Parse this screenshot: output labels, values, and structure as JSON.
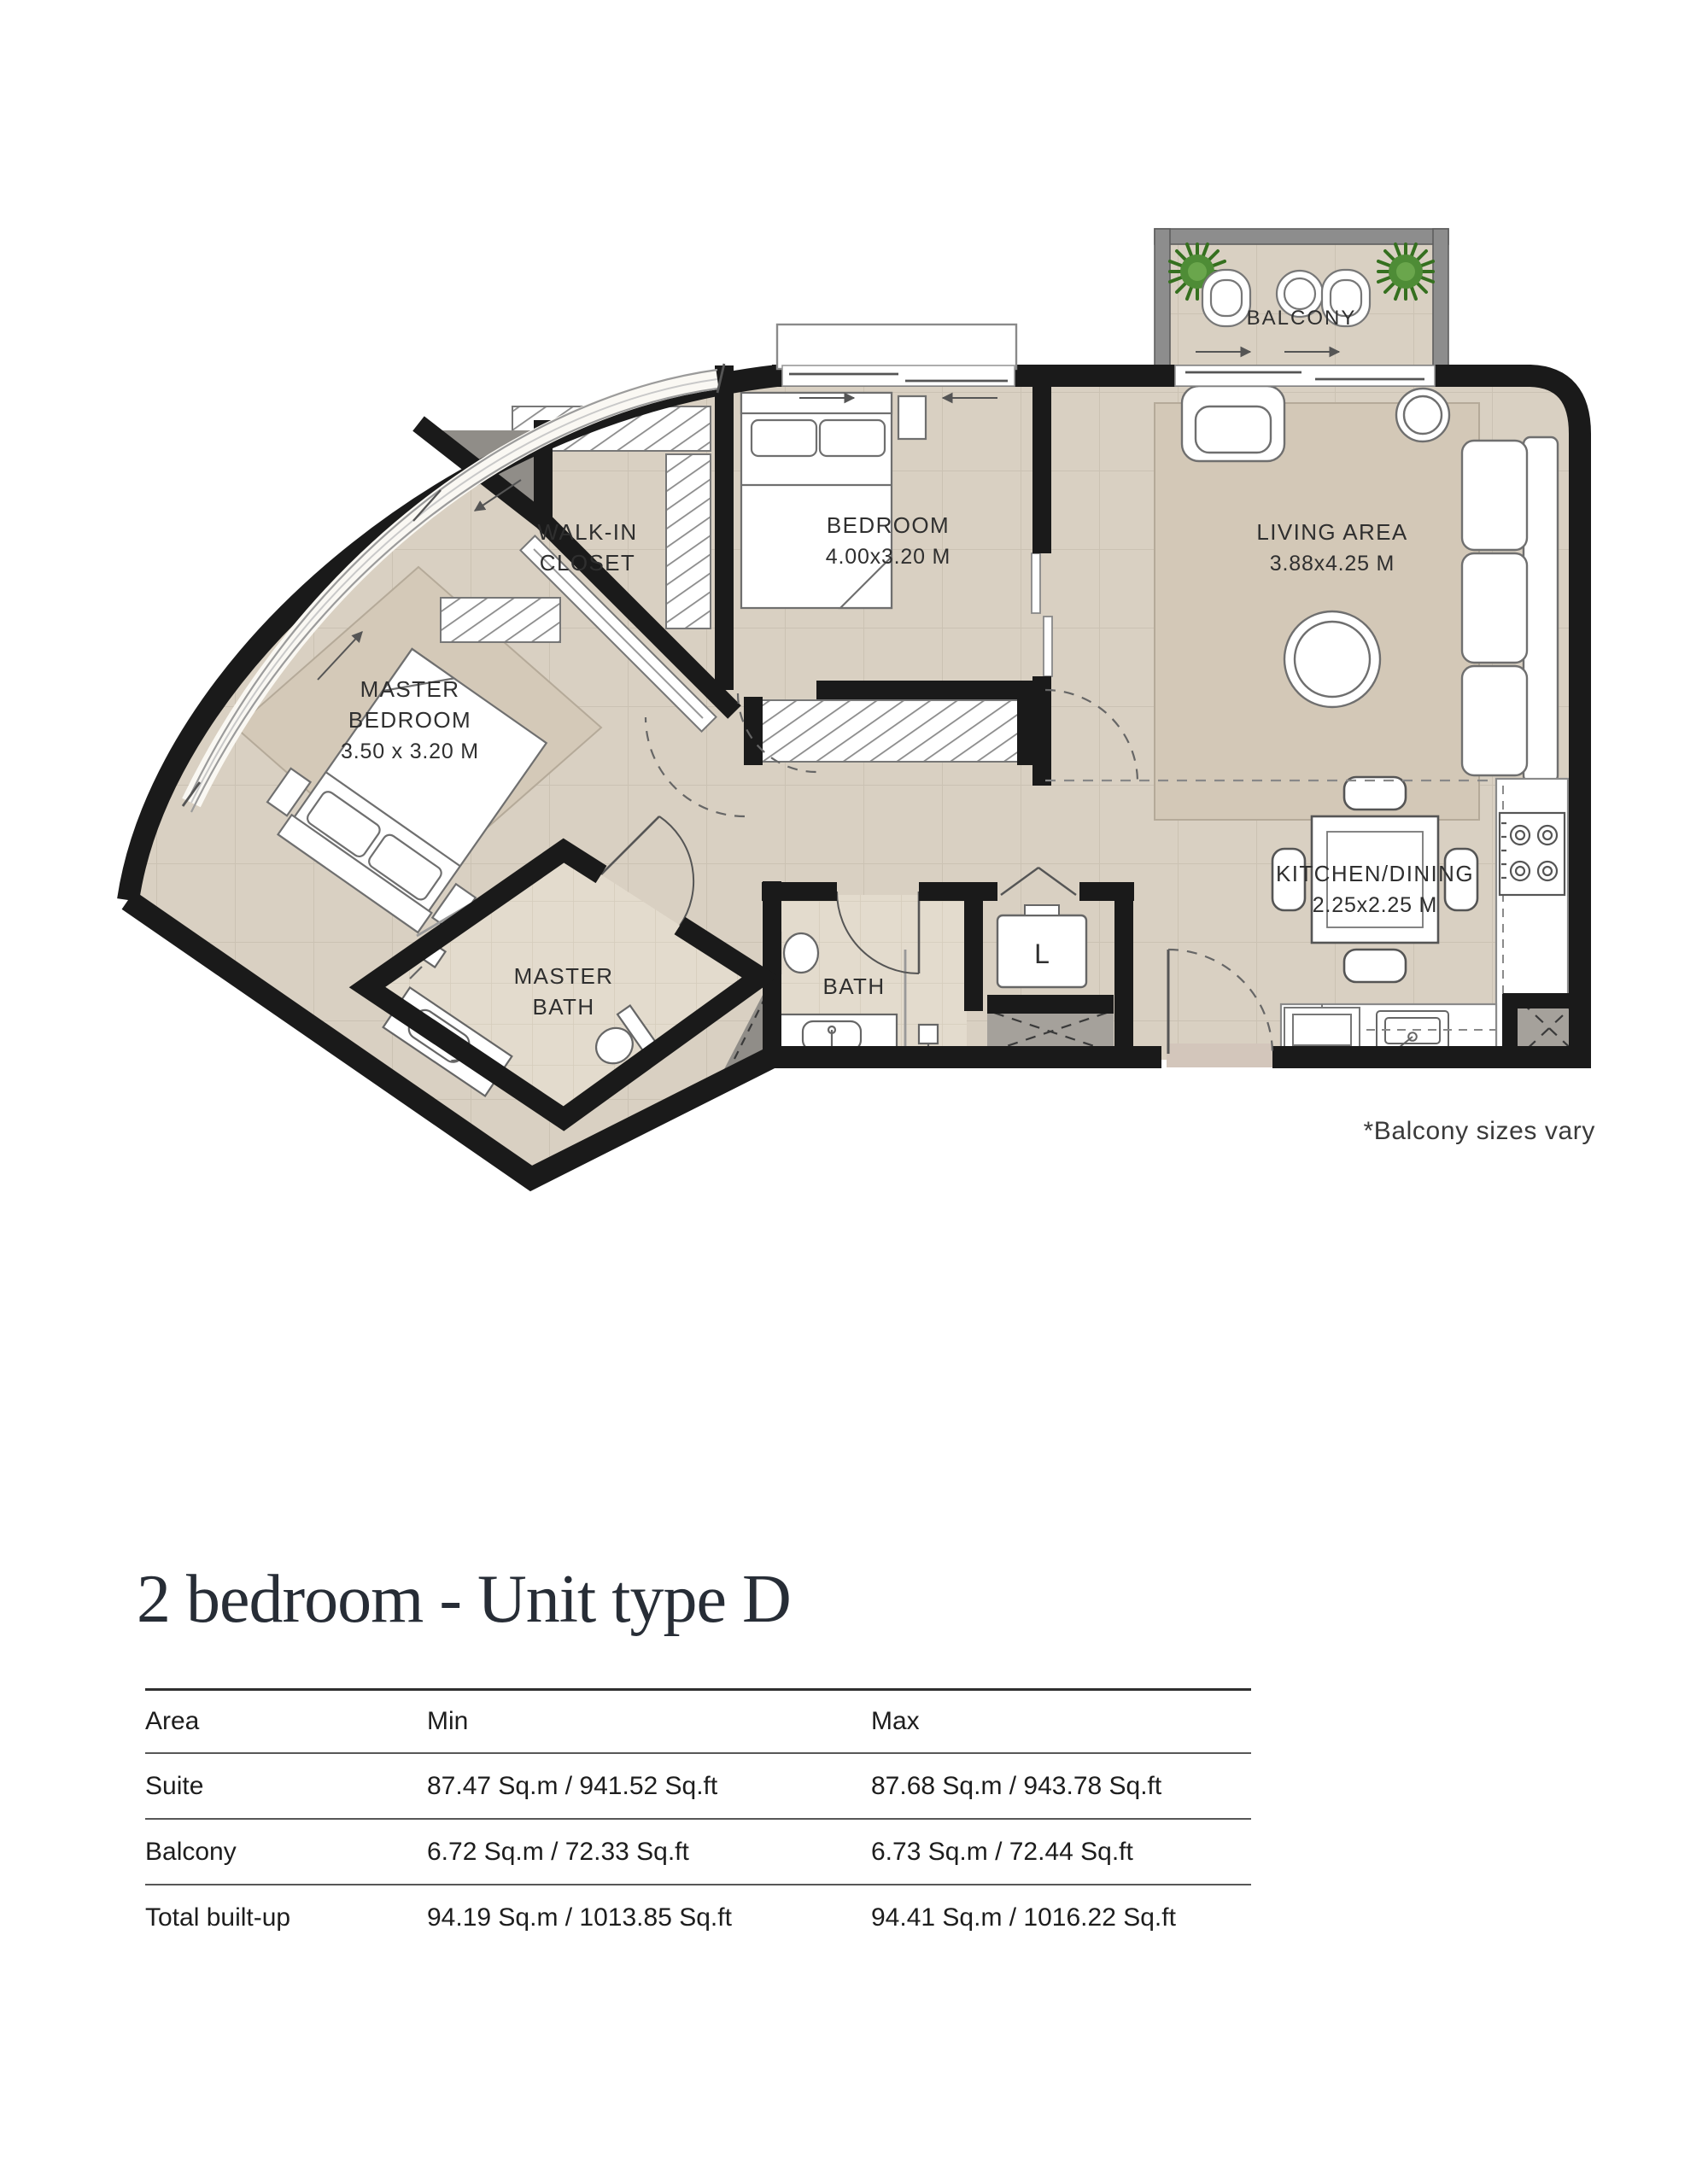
{
  "page": {
    "title": "2 bedroom - Unit type D",
    "note": "*Balcony sizes vary"
  },
  "plan": {
    "rooms": {
      "balcony": {
        "label": "BALCONY"
      },
      "living": {
        "label": "LIVING AREA",
        "dims": "3.88x4.25 M"
      },
      "bedroom": {
        "label": "BEDROOM",
        "dims": "4.00x3.20 M"
      },
      "master_bedroom": {
        "line1": "MASTER",
        "line2": "BEDROOM",
        "dims": "3.50 x 3.20 M"
      },
      "walk_in_closet": {
        "line1": "WALK-IN",
        "line2": "CLOSET"
      },
      "kitchen": {
        "label": "KITCHEN/DINING",
        "dims": "2.25x2.25 M"
      },
      "master_bath": {
        "line1": "MASTER",
        "line2": "BATH"
      },
      "bath": {
        "label": "BATH"
      },
      "laundry": {
        "label": "L"
      }
    },
    "colors": {
      "floor_tile": "#d9d0c2",
      "tile_line": "#cbc2b3",
      "bath_tile": "#e3dbcd",
      "wall": "#1a1a1a",
      "balcony_wall": "#8d8d8d",
      "rug": "#d3c8b7",
      "shaft_gray": "#a5a19b",
      "shaft_dark": "#908d88",
      "plant_green": "#4e8c36",
      "furniture_outline": "#6f6f6f",
      "label_text": "#2f2f2f",
      "title_text": "#272d36"
    }
  },
  "table": {
    "columns": [
      "Area",
      "Min",
      "Max"
    ],
    "rows": [
      {
        "area": "Suite",
        "min": "87.47 Sq.m / 941.52 Sq.ft",
        "max": "87.68 Sq.m / 943.78 Sq.ft"
      },
      {
        "area": "Balcony",
        "min": "6.72 Sq.m / 72.33 Sq.ft",
        "max": "6.73 Sq.m / 72.44 Sq.ft"
      },
      {
        "area": "Total built-up",
        "min": "94.19 Sq.m / 1013.85 Sq.ft",
        "max": "94.41 Sq.m / 1016.22 Sq.ft"
      }
    ]
  }
}
